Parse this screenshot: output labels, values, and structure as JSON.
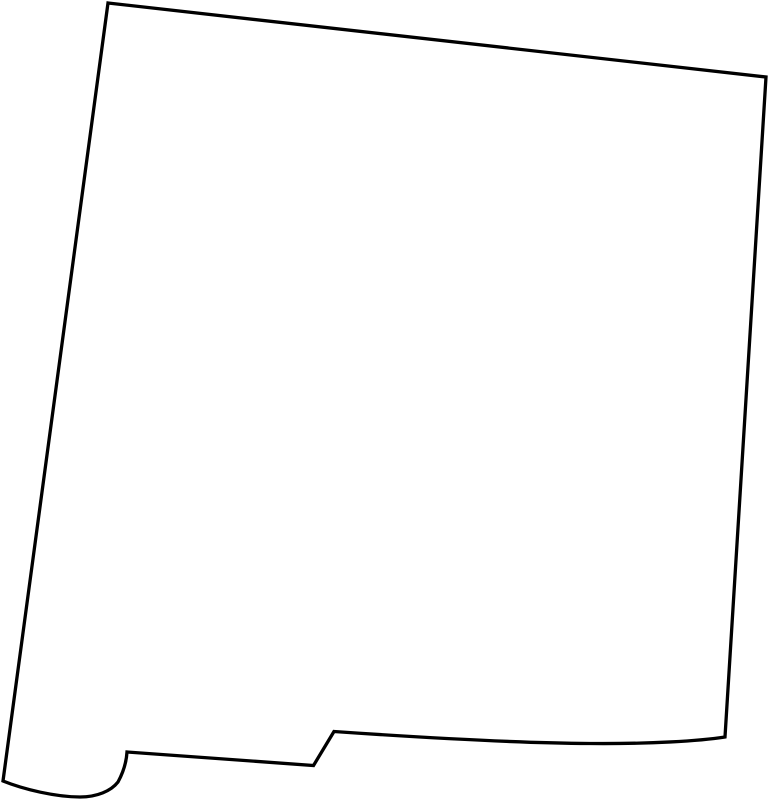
{
  "page": {
    "width": 769,
    "height": 800,
    "background_color": "#ffffff"
  },
  "map": {
    "region": "New Mexico",
    "kind": "blank state outline map",
    "viewbox": "0 0 769 800",
    "stroke_color": "#000000",
    "fill_color": "#ffffff",
    "stroke_width": "3.3",
    "outline_path": "M 108,3 L 766,77 L 725,737 C 700,741 650,744 590,743.5 C 520,743 420,737.5 334,731.5 L 313.5,765.5 L 127,752 C 126.5,760 124,771 118,782 C 111,791 97,797 80,797 C 56,797 24,789.5 3,781 Z"
  }
}
